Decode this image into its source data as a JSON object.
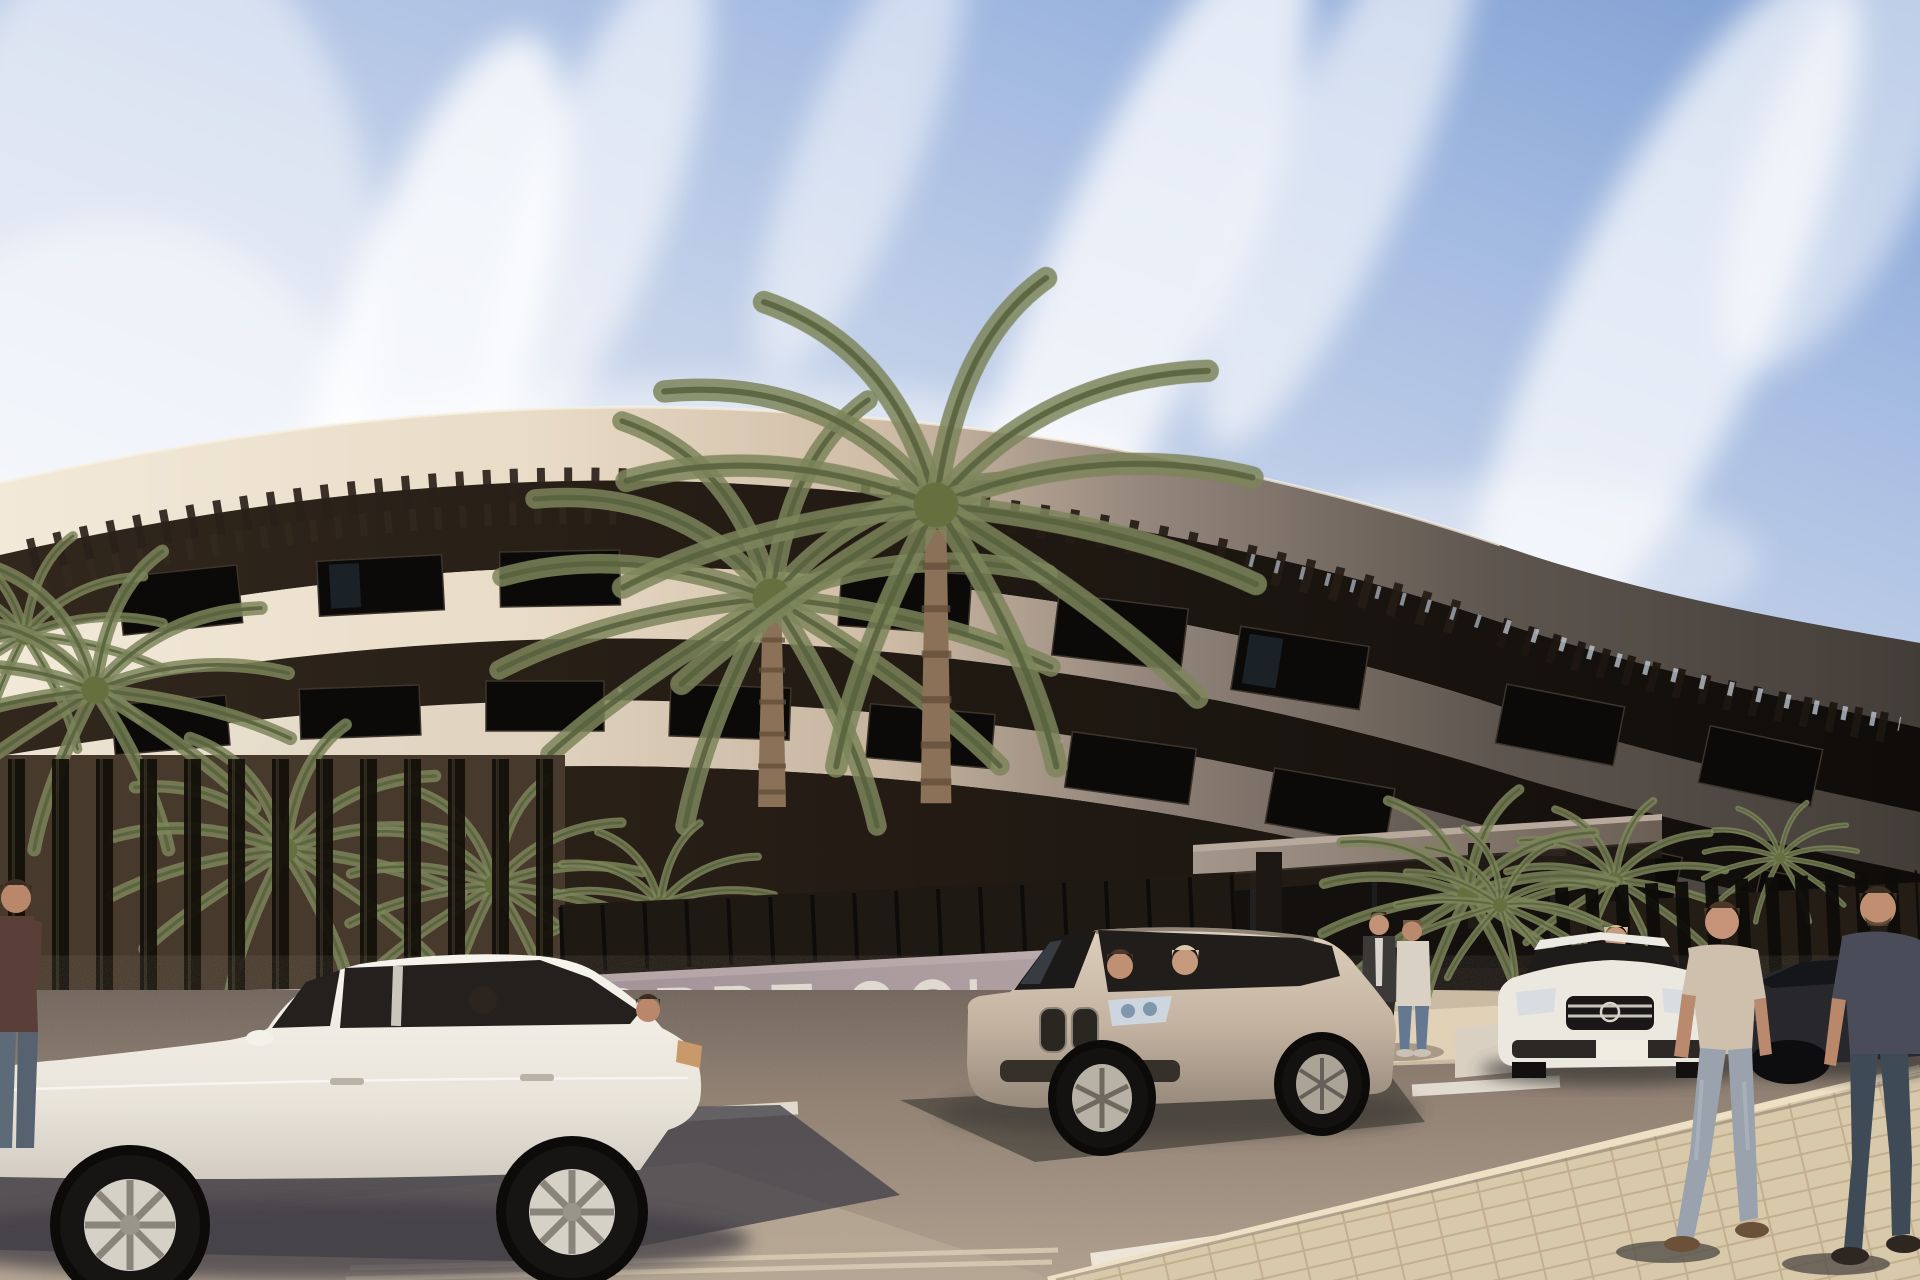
{
  "scene": {
    "type": "exterior-architectural-rendering",
    "setting": "Modern curved cream apartment building (Torre Golf) on a sunny day with palm trees, a street wall sign, parked cars and pedestrians",
    "sign": {
      "text": "TORRE GOL",
      "style": "large white capital letters on street wall, right end hidden behind SUV",
      "letter_color": "#eae3da",
      "wall_color": "#a3939a"
    },
    "sky": {
      "base_color": "#c7d4ea",
      "deep_corner_color": "#7e9ed1",
      "clouds": "wispy diagonal white streaks"
    },
    "building": {
      "floors_visible": 3,
      "band_sunlit_color": "#ece2d0",
      "band_shadow_color": "#453f39",
      "recess_color": "#1d1711",
      "features": [
        "curved horizontal fascia bands",
        "dark recessed glazed floors",
        "rooftop pergola slats",
        "entrance canopy with columns",
        "vertical slat perimeter fence"
      ]
    },
    "vehicles": [
      {
        "name": "white-sedan",
        "color": "#f0ece3",
        "position": "left foreground, side view, driver and rear passenger visible"
      },
      {
        "name": "champagne-suv",
        "color": "#c3b2a0",
        "position": "center, three-quarter front view, two occupants"
      },
      {
        "name": "white-mercedes",
        "color": "#ebe8e0",
        "position": "right, front view, woman standing behind"
      },
      {
        "name": "dark-sedan",
        "color": "#28282c",
        "position": "far right, partly hidden by pedestrians"
      }
    ],
    "people": [
      {
        "name": "pedestrian-partial-left",
        "detail": "maroon shirt, cut by left edge"
      },
      {
        "name": "standing-pair-entrance",
        "detail": "one dark jacket facing viewer, one cream jacket with blue jeans, back turned"
      },
      {
        "name": "woman-by-mercedes",
        "detail": "blonde, light top"
      },
      {
        "name": "walking-man-tan",
        "detail": "tan t-shirt, light jeans, walking away"
      },
      {
        "name": "walking-man-dark",
        "detail": "dark grey t-shirt, dark jeans, walking away, right edge"
      }
    ],
    "vegetation": {
      "tall_center_palms": 2,
      "palm_clusters_behind_fence": "left row and right pair",
      "entrance_bush": 1
    },
    "ground": {
      "road_color": "#8b7b6c",
      "sunlit_asphalt": "#b7a693",
      "markings": [
        "dashed white lane lines",
        "bright angled stripe lower right",
        "double curb lines bottom"
      ],
      "sidewalk": "cream brick pavers, bottom right wedge"
    }
  }
}
